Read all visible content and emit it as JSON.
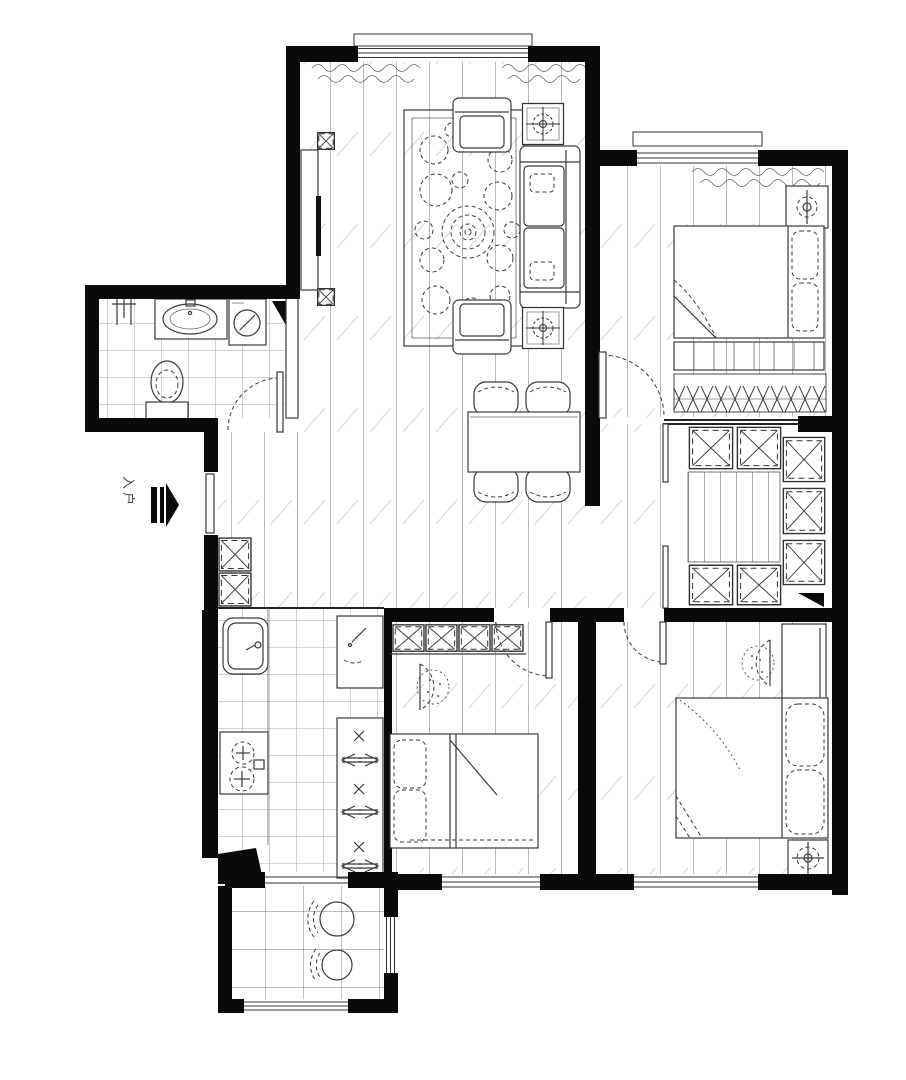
{
  "entry": {
    "label": "入户"
  },
  "colors": {
    "walls": "#0a0a0a",
    "furniture_line": "#3a3a3a",
    "floor_plank_line": "#b3b3b3",
    "hatch_line": "#cfcfcf",
    "tile_line": "#8a8a8a",
    "background": "#ffffff"
  },
  "icons": {
    "entry_direction": "arrow-right-icon",
    "lamps": "table-lamp-icon",
    "wardrobe_cells": "x-crossed-box-icon",
    "washing_machine": "drum-washer-icon"
  }
}
